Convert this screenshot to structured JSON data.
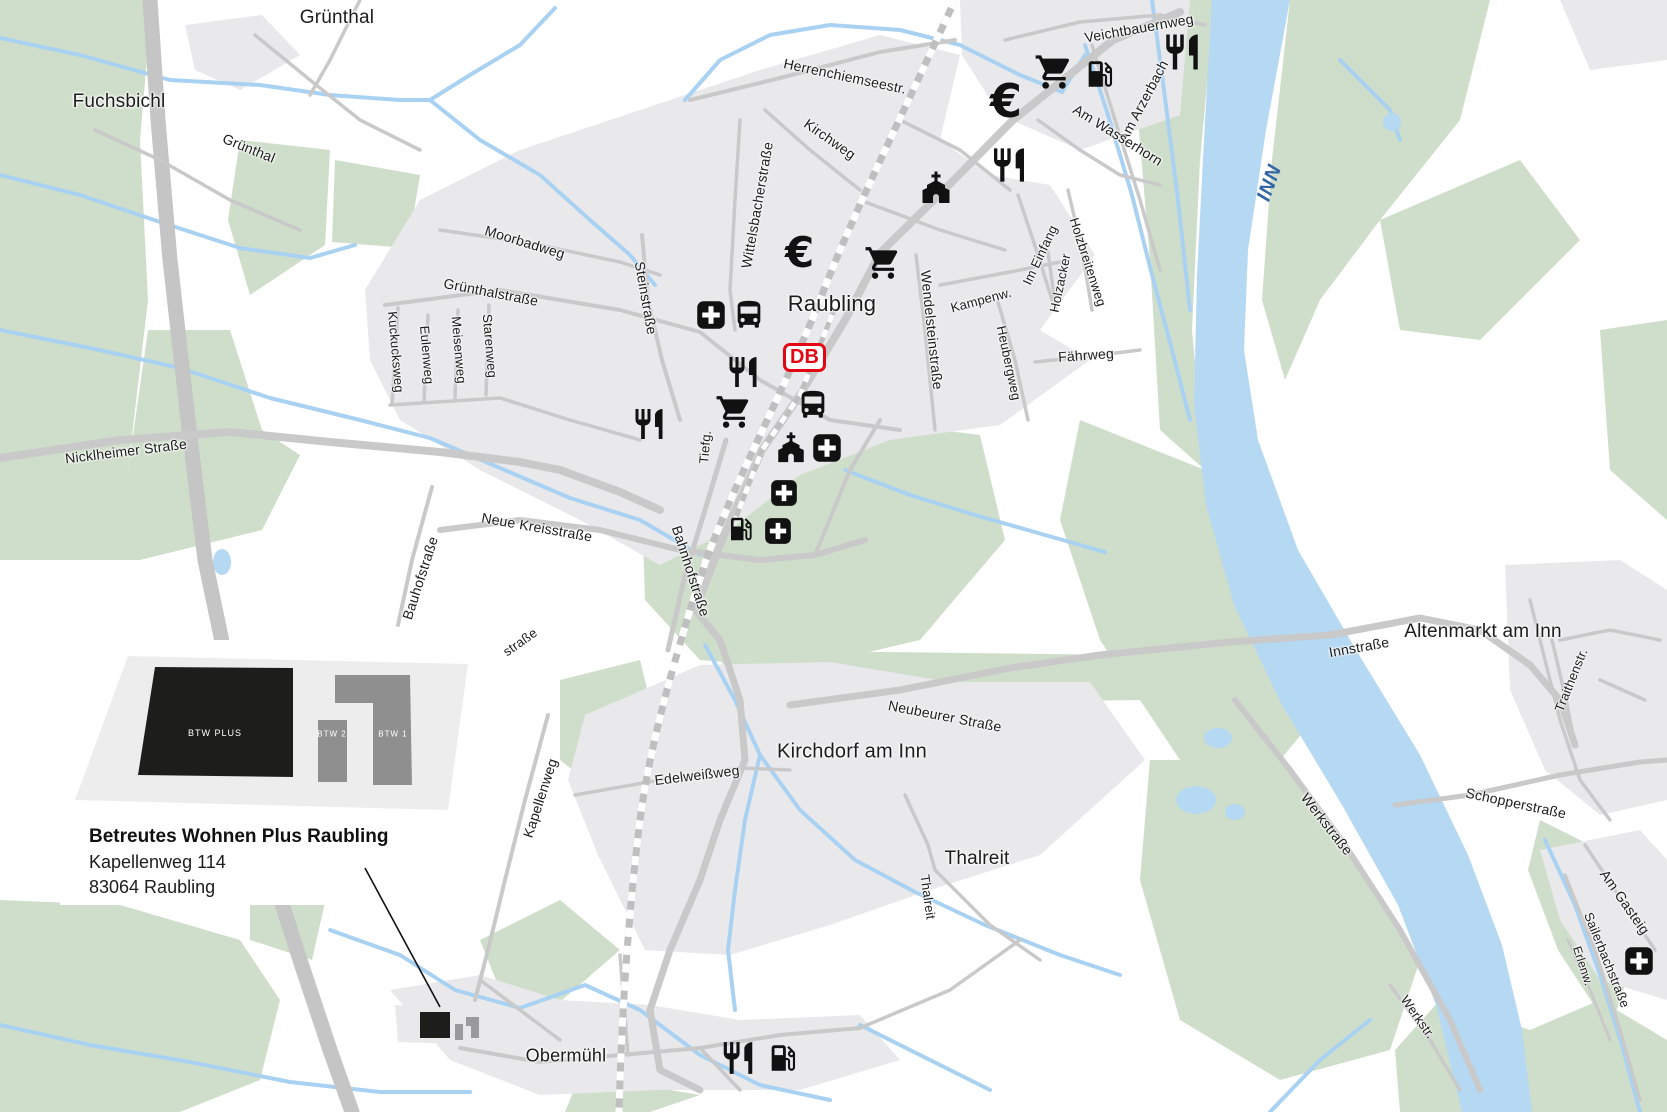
{
  "colors": {
    "green": "#cfdeca",
    "urban": "#e9e9eb",
    "water_fill": "#b5d8f3",
    "water_line": "#a9d2f2",
    "road": "#c9c9ca",
    "rail": "#bfbfbf",
    "black": "#1c1c1c",
    "db_red": "#e30613",
    "inn_label_blue": "#3465a4",
    "bld_dark": "#1d1d1b",
    "bld_gray": "#8f8f8f"
  },
  "map": {
    "places": [
      {
        "label": "Grünthal",
        "x": 337,
        "y": 18,
        "size": 19
      },
      {
        "label": "Fuchsbichl",
        "x": 119,
        "y": 102,
        "size": 19
      },
      {
        "label": "Raubling",
        "x": 832,
        "y": 304,
        "size": 22
      },
      {
        "label": "Kirchdorf am Inn",
        "x": 852,
        "y": 752,
        "size": 20
      },
      {
        "label": "Thalreit",
        "x": 977,
        "y": 859,
        "size": 19
      },
      {
        "label": "Obermühl",
        "x": 566,
        "y": 1056,
        "size": 18
      },
      {
        "label": "Altenmarkt am Inn",
        "x": 1483,
        "y": 632,
        "size": 19
      }
    ],
    "streets": [
      {
        "label": "Grünthal",
        "x": 249,
        "y": 148,
        "rot": 22,
        "size": 14
      },
      {
        "label": "Herrenchiemseestr.",
        "x": 845,
        "y": 76,
        "rot": 12,
        "size": 14
      },
      {
        "label": "Kirchweg",
        "x": 830,
        "y": 139,
        "rot": 35,
        "size": 14
      },
      {
        "label": "Wittelsbacherstraße",
        "x": 757,
        "y": 205,
        "rot": -80,
        "size": 14
      },
      {
        "label": "Veichtbauernweg",
        "x": 1139,
        "y": 28,
        "rot": -10,
        "size": 14
      },
      {
        "label": "Am Arzerbach",
        "x": 1143,
        "y": 101,
        "rot": -62,
        "size": 14
      },
      {
        "label": "Am Wasserhorn",
        "x": 1118,
        "y": 135,
        "rot": 32,
        "size": 14
      },
      {
        "label": "Moorbadweg",
        "x": 525,
        "y": 242,
        "rot": 17,
        "size": 14
      },
      {
        "label": "Grünthalstraße",
        "x": 491,
        "y": 292,
        "rot": 11,
        "size": 14
      },
      {
        "label": "Steinstraße",
        "x": 646,
        "y": 298,
        "rot": 80,
        "size": 14
      },
      {
        "label": "Kuckucksweg",
        "x": 396,
        "y": 352,
        "rot": 85,
        "size": 13
      },
      {
        "label": "Eulenweg",
        "x": 427,
        "y": 355,
        "rot": 85,
        "size": 13
      },
      {
        "label": "Meisenweg",
        "x": 459,
        "y": 350,
        "rot": 85,
        "size": 13
      },
      {
        "label": "Starenweg",
        "x": 490,
        "y": 346,
        "rot": 85,
        "size": 13
      },
      {
        "label": "Nicklheimer Straße",
        "x": 126,
        "y": 451,
        "rot": -7,
        "size": 14
      },
      {
        "label": "Neue Kreisstraße",
        "x": 537,
        "y": 527,
        "rot": 10,
        "size": 14
      },
      {
        "label": "Bauhofstraße",
        "x": 420,
        "y": 578,
        "rot": -72,
        "size": 14
      },
      {
        "label": "Bahnhofstraße",
        "x": 691,
        "y": 571,
        "rot": 72,
        "size": 14
      },
      {
        "label": "Tiefg.",
        "x": 705,
        "y": 447,
        "rot": -85,
        "size": 13
      },
      {
        "label": "Wendelsteinstraße",
        "x": 932,
        "y": 330,
        "rot": 84,
        "size": 14
      },
      {
        "label": "Kampenw.",
        "x": 981,
        "y": 300,
        "rot": -15,
        "size": 13
      },
      {
        "label": "Heubergweg",
        "x": 1009,
        "y": 363,
        "rot": 78,
        "size": 13
      },
      {
        "label": "Im Einfang",
        "x": 1040,
        "y": 255,
        "rot": -65,
        "size": 13
      },
      {
        "label": "Holzbreitenweg",
        "x": 1088,
        "y": 262,
        "rot": 72,
        "size": 13
      },
      {
        "label": "Holzacker",
        "x": 1060,
        "y": 283,
        "rot": -78,
        "size": 13
      },
      {
        "label": "Fährweg",
        "x": 1086,
        "y": 355,
        "rot": -4,
        "size": 14
      },
      {
        "label": "Kapellenweg",
        "x": 540,
        "y": 798,
        "rot": -72,
        "size": 14
      },
      {
        "label": "Edelweißweg",
        "x": 697,
        "y": 775,
        "rot": -7,
        "size": 14
      },
      {
        "label": "Neubeurer Straße",
        "x": 945,
        "y": 716,
        "rot": 11,
        "size": 14
      },
      {
        "label": "Thalreit",
        "x": 928,
        "y": 897,
        "rot": 82,
        "size": 13
      },
      {
        "label": "Innstraße",
        "x": 1359,
        "y": 647,
        "rot": -10,
        "size": 14
      },
      {
        "label": "Traithenstr.",
        "x": 1571,
        "y": 680,
        "rot": -68,
        "size": 13
      },
      {
        "label": "Schopperstraße",
        "x": 1516,
        "y": 803,
        "rot": 12,
        "size": 14
      },
      {
        "label": "Werkstraße",
        "x": 1327,
        "y": 824,
        "rot": 52,
        "size": 14
      },
      {
        "label": "Werkstr.",
        "x": 1418,
        "y": 1017,
        "rot": 55,
        "size": 13
      },
      {
        "label": "Am Gasteig",
        "x": 1625,
        "y": 902,
        "rot": 55,
        "size": 14
      },
      {
        "label": "Sailerbachstraße",
        "x": 1607,
        "y": 960,
        "rot": 68,
        "size": 13
      },
      {
        "label": "Erlenw.",
        "x": 1583,
        "y": 966,
        "rot": 72,
        "size": 12
      },
      {
        "label": "straße",
        "x": 520,
        "y": 642,
        "rot": -35,
        "size": 13
      }
    ],
    "water_labels": [
      {
        "label": "INN",
        "x": 1270,
        "y": 183,
        "rot": -70,
        "size": 20
      }
    ],
    "icons": [
      {
        "type": "cart",
        "x": 1054,
        "y": 72,
        "size": 40
      },
      {
        "type": "fuel",
        "x": 1100,
        "y": 74,
        "size": 34
      },
      {
        "type": "restaurant",
        "x": 1182,
        "y": 52,
        "size": 42
      },
      {
        "type": "euro",
        "x": 1013,
        "y": 101,
        "size": 46
      },
      {
        "type": "restaurant",
        "x": 1009,
        "y": 165,
        "size": 40
      },
      {
        "type": "church",
        "x": 936,
        "y": 188,
        "size": 36
      },
      {
        "type": "euro",
        "x": 806,
        "y": 253,
        "size": 42
      },
      {
        "type": "cart",
        "x": 883,
        "y": 263,
        "size": 38
      },
      {
        "type": "cross",
        "x": 711,
        "y": 315,
        "size": 30
      },
      {
        "type": "bus",
        "x": 749,
        "y": 315,
        "size": 34
      },
      {
        "type": "restaurant",
        "x": 743,
        "y": 372,
        "size": 36
      },
      {
        "type": "cart",
        "x": 734,
        "y": 412,
        "size": 38
      },
      {
        "type": "bus",
        "x": 813,
        "y": 405,
        "size": 34
      },
      {
        "type": "restaurant",
        "x": 649,
        "y": 424,
        "size": 36
      },
      {
        "type": "church",
        "x": 791,
        "y": 448,
        "size": 34
      },
      {
        "type": "cross",
        "x": 827,
        "y": 448,
        "size": 30
      },
      {
        "type": "cross",
        "x": 784,
        "y": 493,
        "size": 28
      },
      {
        "type": "fuel",
        "x": 741,
        "y": 529,
        "size": 30
      },
      {
        "type": "cross",
        "x": 778,
        "y": 531,
        "size": 28
      },
      {
        "type": "restaurant",
        "x": 738,
        "y": 1058,
        "size": 38
      },
      {
        "type": "fuel",
        "x": 783,
        "y": 1058,
        "size": 34
      },
      {
        "type": "cross",
        "x": 1639,
        "y": 961,
        "size": 30
      }
    ],
    "db_logo": {
      "text": "DB",
      "x": 806,
      "y": 357
    }
  },
  "legend": {
    "title": "Betreutes Wohnen Plus Raubling",
    "address1": "Kapellenweg 114",
    "address2": "83064 Raubling",
    "buildings": [
      {
        "label": "BTW PLUS"
      },
      {
        "label": "BTW 2"
      },
      {
        "label": "BTW 1"
      }
    ]
  }
}
